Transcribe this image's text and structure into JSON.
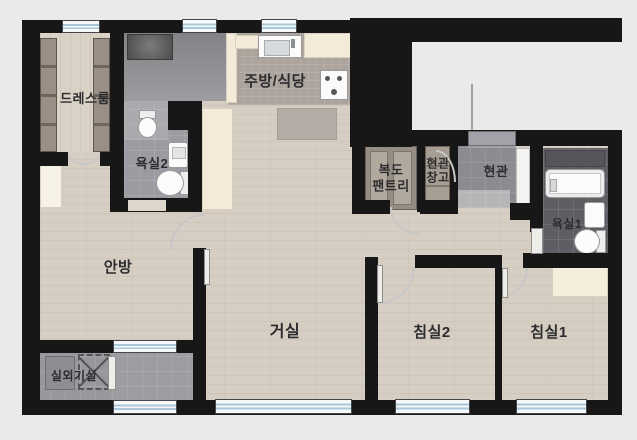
{
  "title": "apartment-floor-plan",
  "colors": {
    "background": "#eaeaea",
    "wall": "#171717",
    "wood_floor": "#d6cdc3",
    "tile_gray": "#95959b",
    "tile_dark": "#5e5e64",
    "cream_cabinet": "#f3ead9",
    "window_glass": "#a9c8da",
    "wardrobe_brown": "#8a8178"
  },
  "rooms": {
    "dressroom": {
      "label": "드레스룸"
    },
    "kitchen_dining": {
      "label": "주방/식당"
    },
    "bathroom2": {
      "label": "욕실2"
    },
    "hall_pantry": {
      "label": "복도\n팬트리"
    },
    "entry_storage": {
      "label": "현관\n창고"
    },
    "entry": {
      "label": "현관"
    },
    "bathroom1": {
      "label": "욕실1"
    },
    "master_bedroom": {
      "label": "안방"
    },
    "living_room": {
      "label": "거실"
    },
    "bedroom2": {
      "label": "침실2"
    },
    "bedroom1": {
      "label": "침실1"
    },
    "outdoor_unit_room": {
      "label": "실외기실"
    }
  },
  "fixtures": [
    "washing-machine",
    "kitchen-sink",
    "gas-stove",
    "dining-rug",
    "hall-cabinet",
    "wardrobe-left",
    "wardrobe-right",
    "master-closet",
    "bedroom1-wardrobe",
    "pantry-shelves",
    "storage-shelves",
    "shoe-cabinet",
    "bathtub",
    "toilet-bath1",
    "toilet-bath2",
    "toilet-compartment",
    "basin-bath1",
    "basin-bath2",
    "outdoor-ac-unit",
    "outdoor-ac-reserved",
    "windows",
    "door-swings"
  ]
}
